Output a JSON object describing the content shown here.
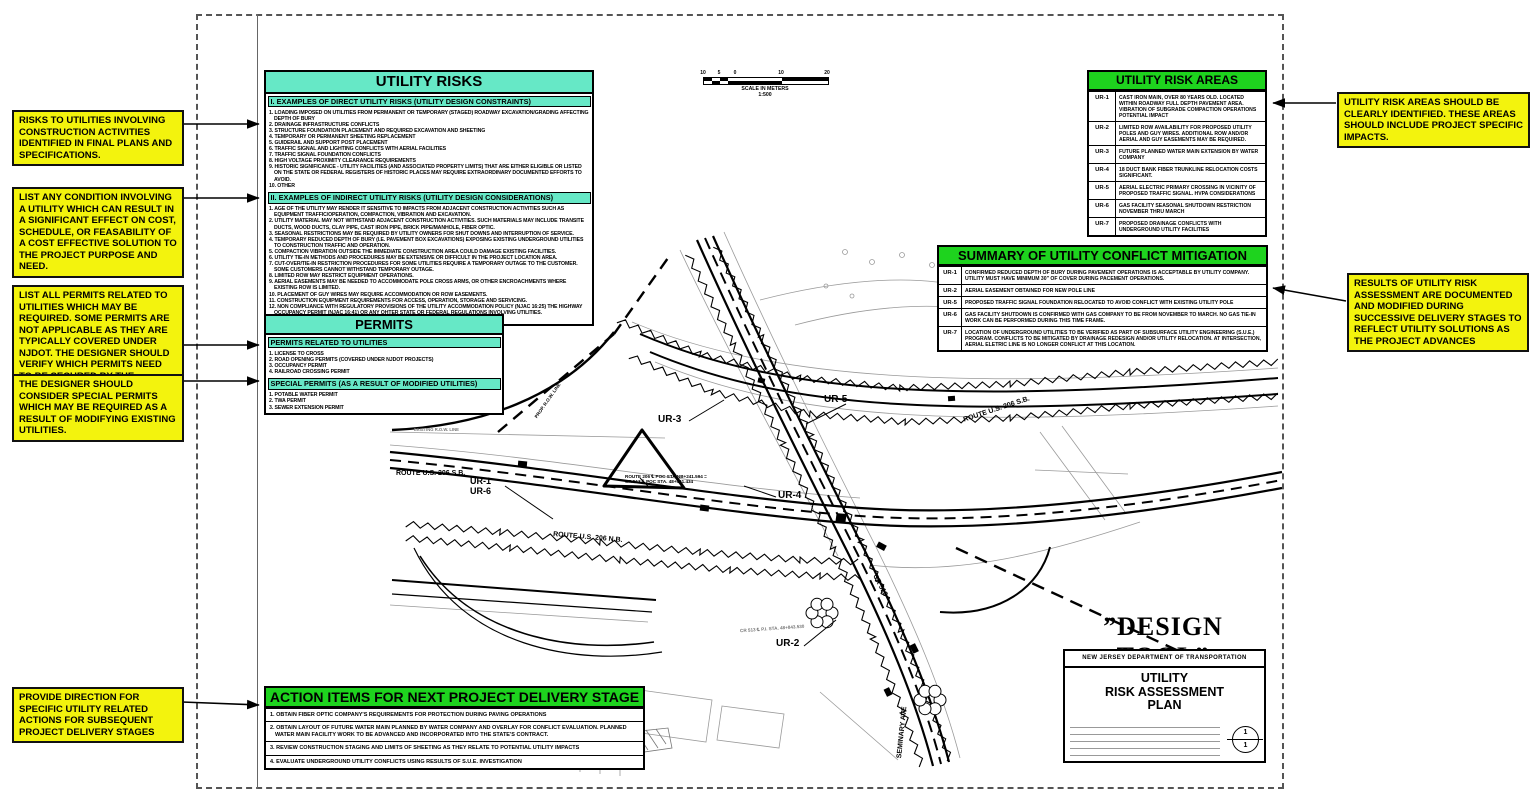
{
  "callouts_left": [
    {
      "text": "RISKS TO UTILITIES INVOLVING CONSTRUCTION ACTIVITIES IDENTIFIED IN FINAL PLANS AND SPECIFICATIONS."
    },
    {
      "text": "LIST ANY CONDITION INVOLVING A UTILITY WHICH CAN RESULT IN A SIGNIFICANT EFFECT ON COST, SCHEDULE, OR FEASABILITY OF A COST EFFECTIVE SOLUTION TO THE PROJECT PURPOSE AND NEED."
    },
    {
      "text": "LIST ALL PERMITS RELATED TO UTILITIES WHICH MAY BE REQUIRED. SOME PERMITS ARE NOT APPLICABLE AS THEY ARE TYPICALLY COVERED UNDER NJDOT. THE DESIGNER SHOULD VERIFY WHICH PERMITS NEED TO BE SECURED BY THE CONTRACTOR."
    },
    {
      "text": "THE DESIGNER SHOULD CONSIDER SPECIAL PERMITS WHICH MAY BE REQUIRED AS A RESULT OF MODIFYING EXISTING UTILITIES."
    },
    {
      "text": "PROVIDE DIRECTION FOR SPECIFIC UTILITY RELATED ACTIONS FOR SUBSEQUENT PROJECT DELIVERY STAGES"
    }
  ],
  "callouts_right": [
    {
      "text": "UTILITY RISK AREAS SHOULD BE CLEARLY IDENTIFIED. THESE AREAS SHOULD INCLUDE PROJECT SPECIFIC IMPACTS."
    },
    {
      "text": "RESULTS OF UTILITY RISK ASSESSMENT ARE DOCUMENTED AND MODIFIED DURING SUCCESSIVE DELIVERY STAGES TO REFLECT UTILITY SOLUTIONS AS THE PROJECT ADVANCES"
    }
  ],
  "utility_risks": {
    "title": "UTILITY RISKS",
    "section1": {
      "title": "I. EXAMPLES OF DIRECT UTILITY RISKS (UTILITY DESIGN CONSTRAINTS)",
      "items": [
        "1. LOADING IMPOSED ON UTILITIES FROM PERMANENT OR TEMPORARY (STAGED) ROADWAY EXCAVATION/GRADING AFFECTING DEPTH OF BURY",
        "2. DRAINAGE INFRASTRUCTURE CONFLICTS",
        "3. STRUCTURE FOUNDATION PLACEMENT AND REQUIRED EXCAVATION AND SHEETING",
        "4. TEMPORARY OR PERMANENT SHEETING REPLACEMENT",
        "5. GUIDERAIL AND SUPPORT POST PLACEMENT",
        "6. TRAFFIC SIGNAL AND LIGHTING CONFLICTS WITH AERIAL FACILITIES",
        "7. TRAFFIC SIGNAL FOUNDATION CONFLICTS",
        "8. HIGH VOLTAGE PROXIMITY CLEARANCE REQUIREMENTS",
        "9. HISTORIC SIGNIFICANCE - UTILITY FACILITIES (AND ASSOCIATED PROPERTY LIMITS) THAT ARE EITHER ELIGIBLE OR LISTED ON THE STATE OR FEDERAL REGISTERS OF HISTORIC PLACES MAY REQUIRE EXTRAORDINARY DOCUMENTED EFFORTS TO AVOID.",
        "10. OTHER"
      ]
    },
    "section2": {
      "title": "II. EXAMPLES OF INDIRECT UTILITY RISKS (UTILITY DESIGN CONSIDERATIONS)",
      "items": [
        "1. AGE OF THE UTILITY MAY RENDER IT SENSITIVE TO IMPACTS FROM ADJACENT CONSTRUCTION ACTIVITIES SUCH AS EQUIPMENT TRAFFIC/OPERATION, COMPACTION, VIBRATION AND EXCAVATION.",
        "2. UTILITY MATERIAL MAY NOT WITHSTAND ADJACENT CONSTRUCTION ACTIVITIES. SUCH MATERIALS MAY INCLUDE TRANSITE DUCTS, WOOD DUCTS, CLAY PIPE, CAST IRON PIPE, BRICK PIPE/MANHOLE, FIBER OPTIC.",
        "3. SEASONAL RESTRICTIONS MAY BE REQUIRED BY UTILITY OWNERS FOR SHUT DOWNS AND INTERRUPTION OF SERVICE.",
        "4. TEMPORARY REDUCED DEPTH OF BURY (I.E. PAVEMENT BOX EXCAVATIONS) EXPOSING EXISTING UNDERGROUND UTILITIES TO CONSTRUCTION TRAFFIC AND OPERATION.",
        "5. COMPACTION VIBRATION OUTSIDE THE IMMEDIATE CONSTRUCTION AREA COULD DAMAGE EXISTING FACILITIES.",
        "6. UTILITY TIE-IN METHODS AND PROCEDURES MAY BE EXTENSIVE OR DIFFICULT IN THE PROJECT LOCATION AREA.",
        "7. CUT-OVER/TIE-IN RESTRICTION PROCEDURES FOR SOME UTILITIES REQUIRE A TEMPORARY OUTAGE TO THE CUSTOMER. SOME CUSTOMERS CANNOT WITHSTAND TEMPORARY OUTAGE.",
        "8. LIMITED ROW MAY RESTRICT EQUIPMENT OPERATIONS.",
        "9. AERIAL EASEMENTS MAY BE NEEDED TO ACCOMMODATE POLE CROSS ARMS, OR OTHER ENCROACHMENTS WHERE EXISTING ROW IS LIMITED.",
        "10. PLACEMENT OF GUY WIRES MAY REQUIRE ACCOMMODATION OR ROW EASEMENTS.",
        "11. CONSTRUCTION EQUIPMENT REQUIREMENTS FOR ACCESS, OPERATION, STORAGE AND SERVICING.",
        "12. NON COMPLIANCE WITH REGULATORY PROVISIONS OF THE UTILITY ACCOMMODATION POLICY (NJAC 16:25) THE HIGHWAY OCCUPANCY PERMIT (NJAC 16:41) OR ANY OHTER STATE OR FEDERAL REGULATIONS INVOLVING UTILITIES.",
        "13. OTHER"
      ]
    }
  },
  "permits": {
    "title": "PERMITS",
    "related_header": "PERMITS RELATED TO UTILITIES",
    "related_items": [
      "1. LICENSE TO CROSS",
      "2. ROAD OPENING PERMITS (COVERED UNDER NJDOT PROJECTS)",
      "3. OCCUPANCY PERMIT",
      "4. RAILROAD CROSSING PERMIT"
    ],
    "special_header": "SPECIAL PERMITS (AS A RESULT OF MODIFIED UTILITIES)",
    "special_items": [
      "1. POTABLE WATER PERMIT",
      "2. TWA PERMIT",
      "3. SEWER EXTENSION PERMIT"
    ]
  },
  "risk_areas": {
    "title": "UTILITY RISK AREAS",
    "rows": [
      {
        "code": "UR-1",
        "text": "CAST IRON MAIN, OVER 80 YEARS OLD. LOCATED WITHIN ROADWAY FULL DEPTH PAVEMENT AREA. VIBRATION OF SUBGRADE COMPACTION OPERATIONS POTENTIAL IMPACT"
      },
      {
        "code": "UR-2",
        "text": "LIMITED ROW AVAILABILITY FOR PROPOSED UTILITY POLES AND GUY WIRES. ADDITIONAL ROW AND/OR AERIAL AND GUY EASEMENTS MAY BE REQUIRED."
      },
      {
        "code": "UR-3",
        "text": "FUTURE PLANNED WATER MAIN EXTENSION BY WATER COMPANY"
      },
      {
        "code": "UR-4",
        "text": "18 DUCT BANK FIBER TRUNKLINE RELOCATION COSTS SIGNIFICANT."
      },
      {
        "code": "UR-5",
        "text": "AERIAL ELECTRIC PRIMARY CROSSING IN VICINITY OF PROPOSED TRAFFIC SIGNAL. HVPA CONSIDERATIONS"
      },
      {
        "code": "UR-6",
        "text": "GAS FACILITY SEASONAL SHUTDOWN RESTRICTION NOVEMBER THRU MARCH"
      },
      {
        "code": "UR-7",
        "text": "PROPOSED DRAINAGE CONFLICTS WITH UNDERGROUND UTILITY FACILITIES"
      }
    ]
  },
  "mitigation": {
    "title": "SUMMARY OF UTILITY CONFLICT MITIGATION",
    "rows": [
      {
        "code": "UR-1",
        "text": "CONFIRMED REDUCED DEPTH OF BURY DURING PAVEMENT OPERATIONS IS ACCEPTABLE BY UTILITY COMPANY. UTILITY MUST HAVE MINIMUM 30\" OF COVER DURING PACEMENT OPERATIONS."
      },
      {
        "code": "UR-2",
        "text": "AERIAL EASEMENT OBTAINED FOR NEW POLE LINE"
      },
      {
        "code": "UR-5",
        "text": "PROPOSED TRAFFIC SIGNAL FOUNDATION RELOCATED TO AVOID CONFLICT WITH EXISTING UTILITY POLE"
      },
      {
        "code": "UR-6",
        "text": "GAS FACILITY SHUTDOWN IS CONFIRMED WITH GAS COMPANY TO BE FROM NOVEMBER TO MARCH. NO GAS TIE-IN WORK CAN BE PERFORMED DURING THIS TIME FRAME."
      },
      {
        "code": "UR-7",
        "text": "LOCATION OF UNDERGROUND UTILITIES TO BE VERIFIED AS PART OF SUBSURFACE UTILITY ENGINEERING (S.U.E.) PROGRAM. CONFLICTS TO BE MITIGATED BY DRAINAGE REDESIGN AND/OR UTILITY RELOCATION. AT INTERSECTION, AERIAL ELETRIC LINE IS NO LONGER CONFLICT AT THIS LOCATION."
      }
    ]
  },
  "action_items": {
    "title": "ACTION ITEMS FOR NEXT PROJECT DELIVERY STAGE",
    "items": [
      "1. OBTAIN FIBER OPTIC COMPANY'S REQUIREMENTS FOR PROTECTION DURING PAVING OPERATIONS",
      "2. OBTAIN LAYOUT OF FUTURE WATER MAIN PLANNED BY WATER COMPANY AND OVERLAY FOR CONFLICT EVALUATION. PLANNED WATER MAIN FACILITY WORK TO BE ADVANCED AND INCORPORATED INTO THE STATE'S CONTRACT.",
      "3. REVIEW CONSTRUCTION STAGING AND LIMITS OF SHEETING AS THEY RELATE TO POTENTIAL UTILITY IMPACTS",
      "4. EVALUATE UNDERGROUND UTILITY CONFLICTS USING RESULTS OF S.U.E. INVESTIGATION"
    ]
  },
  "scale_bar": {
    "numbers": [
      "10",
      "5",
      "0",
      "10",
      "20"
    ],
    "label1": "SCALE IN METERS",
    "label2": "1:500"
  },
  "title_block": {
    "design_tool": "”DESIGN TOOL”",
    "agency": "NEW JERSEY DEPARTMENT OF TRANSPORTATION",
    "plan_lines": [
      "UTILITY",
      "RISK ASSESSMENT",
      "PLAN"
    ],
    "sheet_number_top": "1",
    "sheet_number_bottom": "1"
  },
  "map_labels": {
    "ur1": "UR-1",
    "ur2": "UR-2",
    "ur3": "UR-3",
    "ur4": "UR-4",
    "ur5": "UR-5",
    "ur6": "UR-6",
    "route_206_sb_left": "ROUTE U.S. 206 S.B.",
    "route_206_nb": "ROUTE U.S. 206 N.B.",
    "route_206_sb_right": "ROUTE U.S. 206 S.B.",
    "cr_513": "CR 513",
    "seminary_ave": "SEMINARY AVE",
    "sta_equation_line1": "ROUTE 206 ℄ POC STA.NB+241.594 =",
    "sta_equation_line2": "CR 513 ℄ POC STA. 48+501.434",
    "sta_pi": "CR 513 ℄ P.I. STA. 48+843.530",
    "prop_row_line": "PROP. R.O.W. LINE",
    "existing_row_line": "EXISTING R.O.W. LINE"
  },
  "colors": {
    "callout_yellow": "#f3f30d",
    "header_teal": "#66e8c6",
    "header_green": "#1ed31e",
    "line_black": "#000000"
  }
}
